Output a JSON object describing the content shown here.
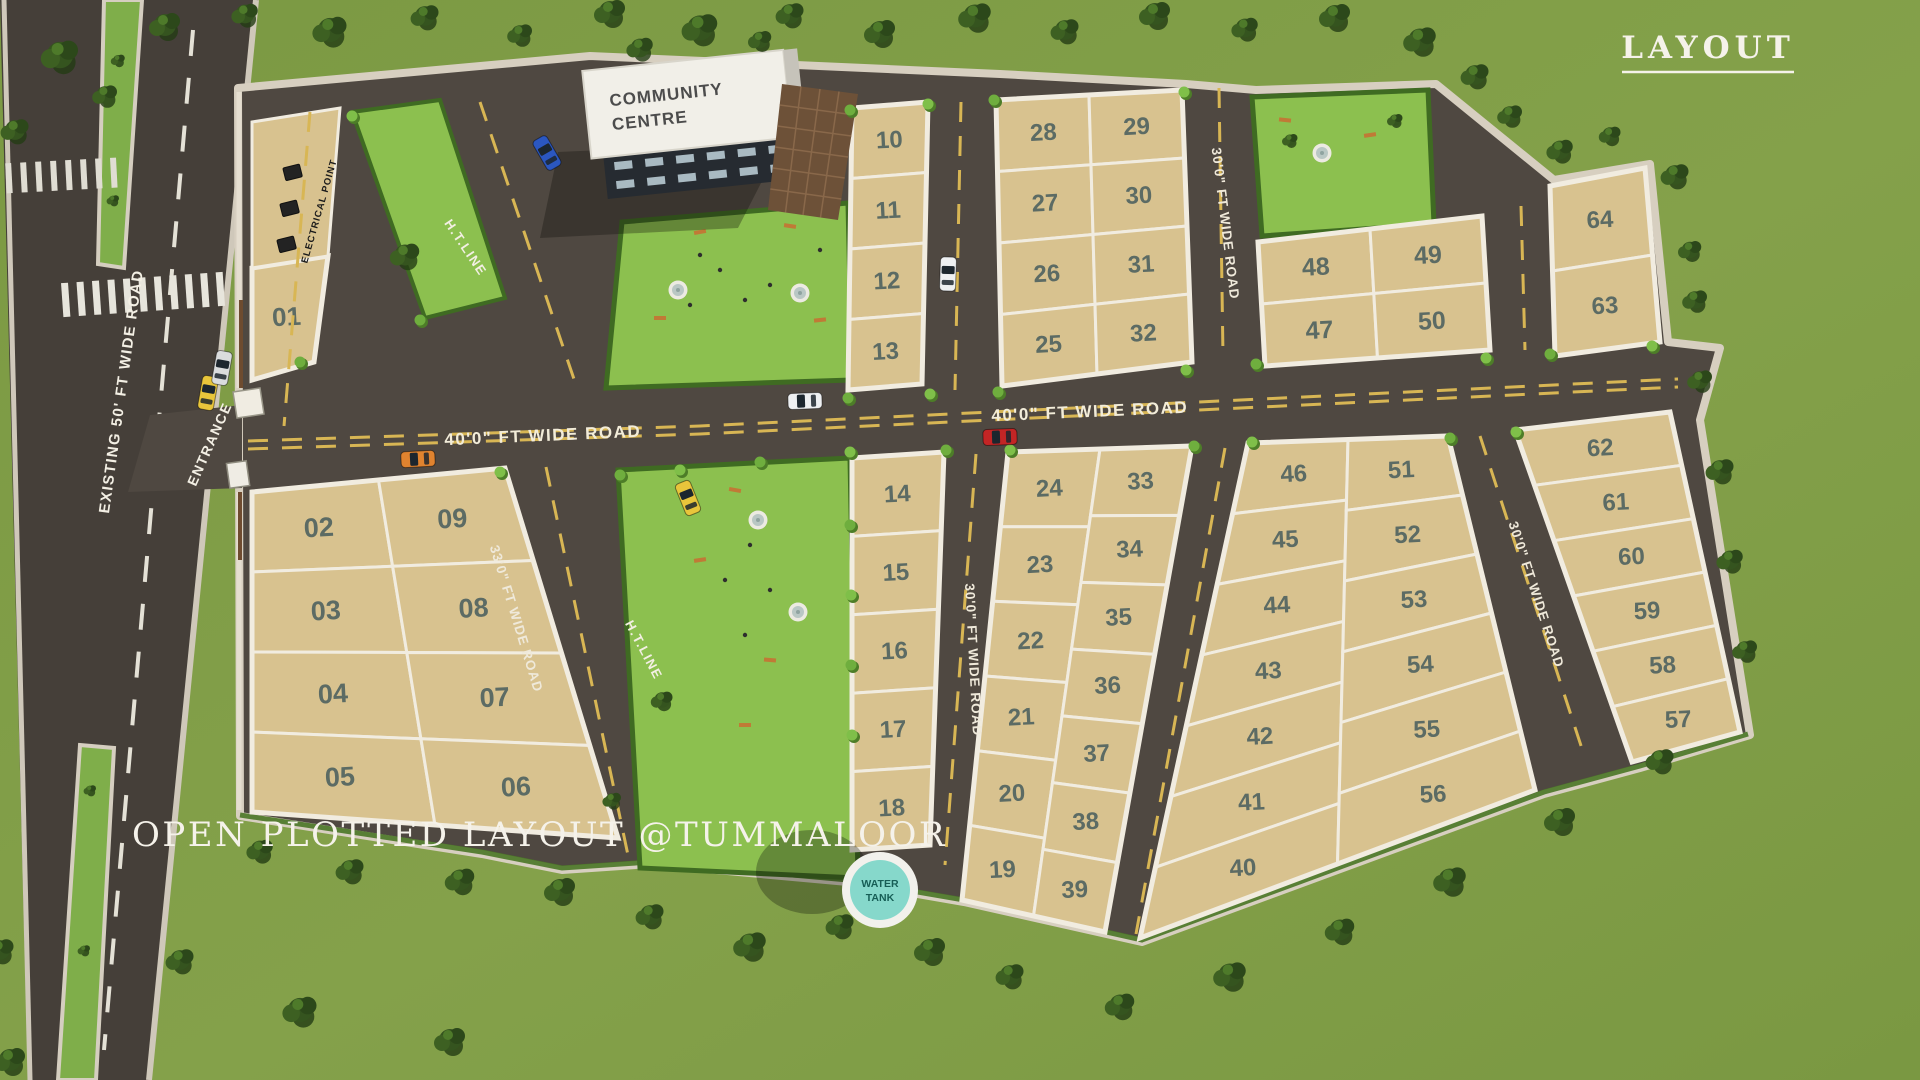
{
  "title": "LAYOUT",
  "subtitle": "OPEN PLOTTED LAYOUT @TUMMALOOR",
  "community_centre": {
    "line1": "COMMUNITY",
    "line2": "CENTRE"
  },
  "water_tank": {
    "line1": "WATER",
    "line2": "TANK"
  },
  "labels": {
    "existing_road": "EXISTING 50' FT WIDE ROAD",
    "entrance": "ENTRANCE",
    "electrical_point": "ELECTRICAL POINT",
    "ht_line_1": "H.T.LINE",
    "ht_line_2": "H.T.LINE",
    "road_40_a": "40'0\" FT WIDE ROAD",
    "road_40_b": "40'0\" FT WIDE ROAD",
    "road_30_north": "30'0\" FT WIDE ROAD",
    "road_30_mid": "30'0\" FT WIDE ROAD",
    "road_30_east": "30'0\" FT WIDE ROAD",
    "road_33": "33'0\" FT WIDE ROAD"
  },
  "blocks": {
    "plot01": {
      "cols": [
        [
          "01"
        ]
      ]
    },
    "b0209": {
      "cols": [
        [
          "02",
          "03",
          "04",
          "05"
        ],
        [
          "09",
          "08",
          "07",
          "06"
        ]
      ]
    },
    "c1013": {
      "cols": [
        [
          "10",
          "11",
          "12",
          "13"
        ]
      ]
    },
    "b2532": {
      "cols": [
        [
          "28",
          "27",
          "26",
          "25"
        ],
        [
          "29",
          "30",
          "31",
          "32"
        ]
      ]
    },
    "b4750": {
      "cols": [
        [
          "48",
          "47"
        ],
        [
          "49",
          "50"
        ]
      ]
    },
    "c6364": {
      "cols": [
        [
          "64",
          "63"
        ]
      ]
    },
    "c1418": {
      "cols": [
        [
          "14",
          "15",
          "16",
          "17",
          "18"
        ]
      ]
    },
    "b1939": {
      "cols": [
        [
          "24",
          "23",
          "22",
          "21",
          "20",
          "19"
        ],
        [
          "33",
          "34",
          "35",
          "36",
          "37",
          "38",
          "39"
        ]
      ]
    },
    "b4056": {
      "cols": [
        [
          "46",
          "45",
          "44",
          "43",
          "42",
          "41",
          "40"
        ],
        [
          "51",
          "52",
          "53",
          "54",
          "55",
          "56"
        ]
      ]
    },
    "c5762": {
      "cols": [
        [
          "62",
          "61",
          "60",
          "59",
          "58",
          "57"
        ]
      ]
    }
  },
  "colors": {
    "grass_green": "#7f9d46",
    "park_green": "#8cc04f",
    "plot_sand": "#d8c28f",
    "road_asphalt": "#4f4841",
    "marking_yellow": "#d8b654",
    "water_tank_teal": "#86d8cb"
  }
}
